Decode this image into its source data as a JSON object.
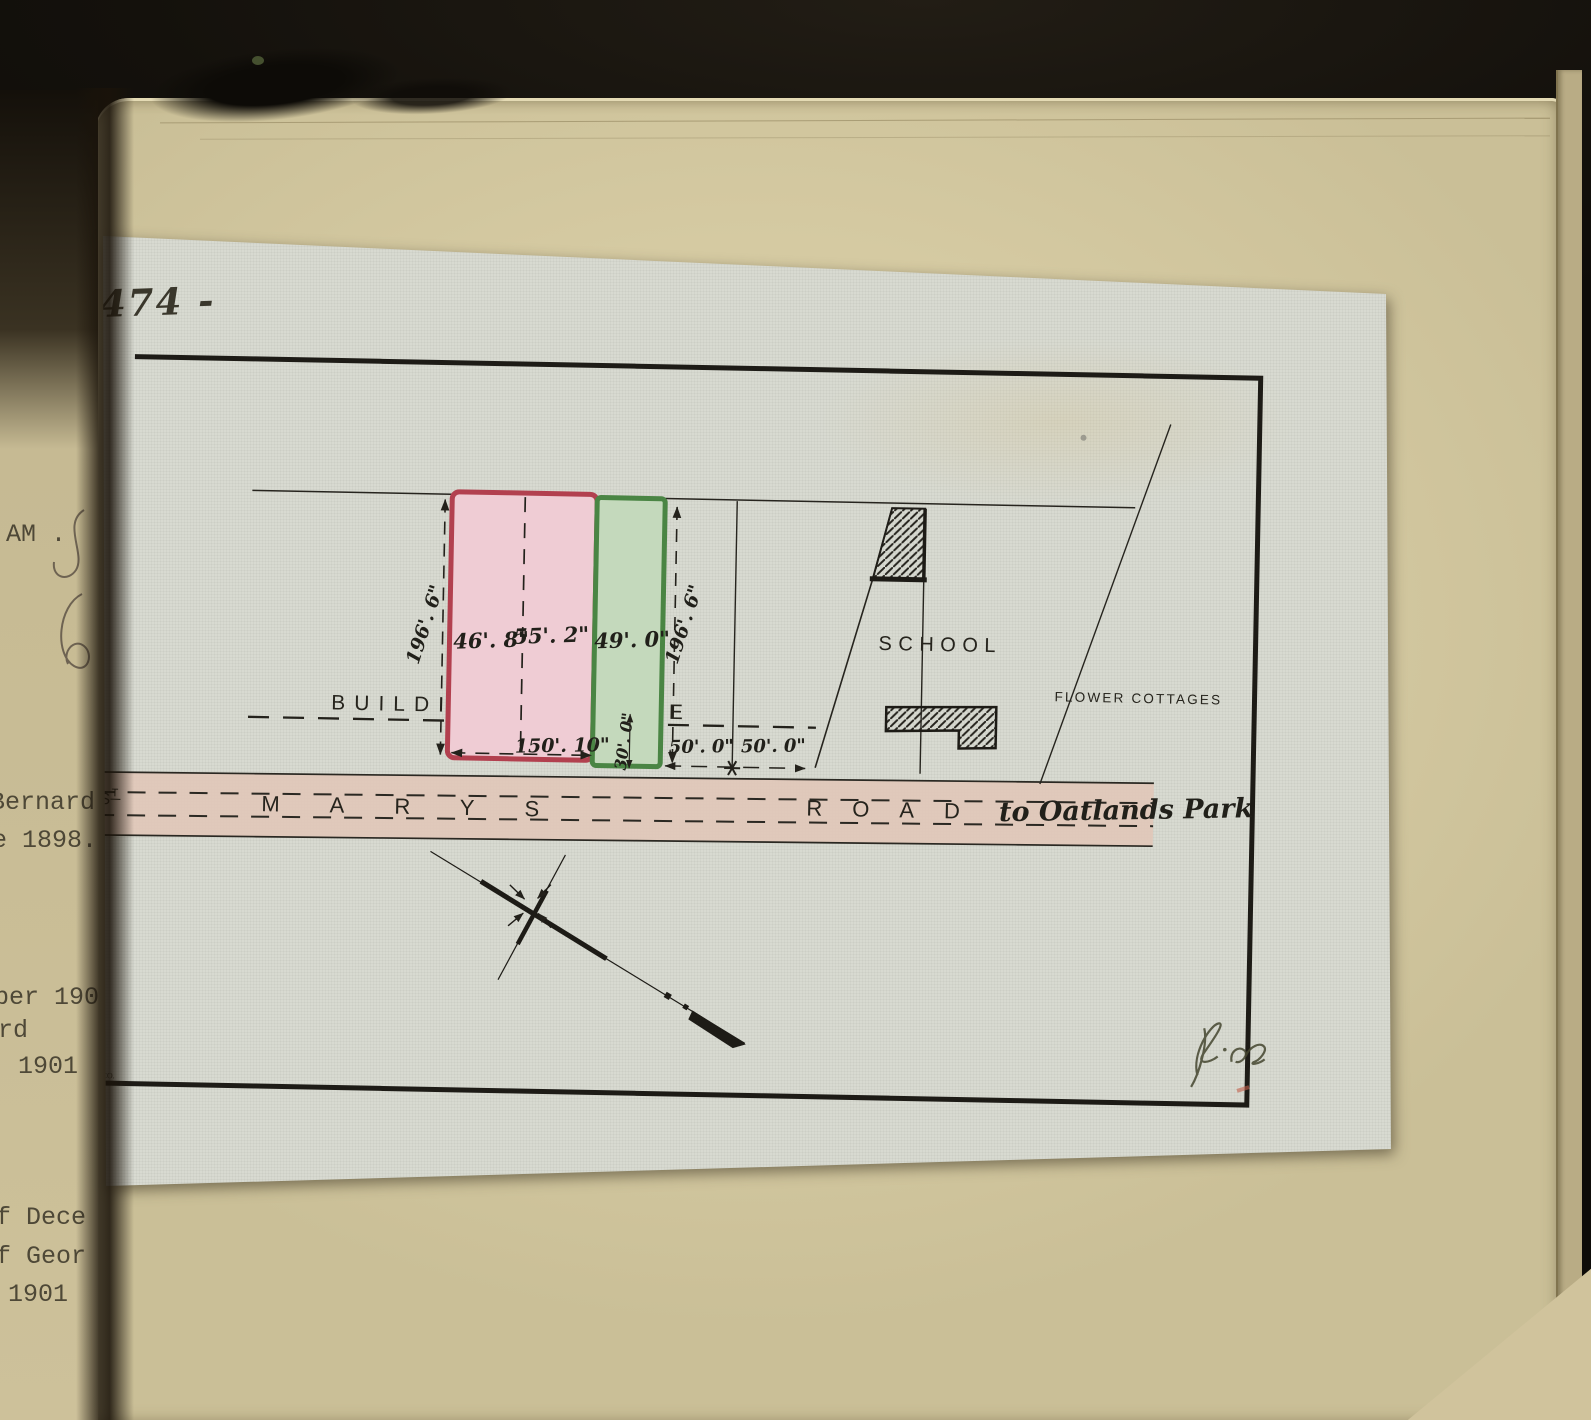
{
  "plan_number": "474 -",
  "labels": {
    "building": "BUILDING",
    "line": "LINE",
    "school": "SCHOOL",
    "flower_cottages": "FLOWER  COTTAGES",
    "road_s": "S",
    "road_t": "T",
    "marys": "MARYS",
    "road": "ROAD",
    "destination": "to Oatlands Park"
  },
  "dims": {
    "depth_left": "196'. 6\"",
    "depth_right": "196'. 6\"",
    "lot_46": "46'. 8\"",
    "lot_55": "55'. 2\"",
    "lot_49": "49'. 0\"",
    "frontage": "150'. 10\"",
    "green_frontage": "30'. 0\"",
    "gap_west": "50'. 0\"",
    "gap_east": "50'. 0\""
  },
  "marks": {
    "printer_top": "R.",
    "printer_bottom": "S. CO."
  },
  "left_page": {
    "fragments": [
      "AM .",
      "Bernard",
      "e 1898.",
      "ber 190",
      "rd",
      "1901",
      "f Dece",
      "f Geor",
      "1901"
    ]
  }
}
